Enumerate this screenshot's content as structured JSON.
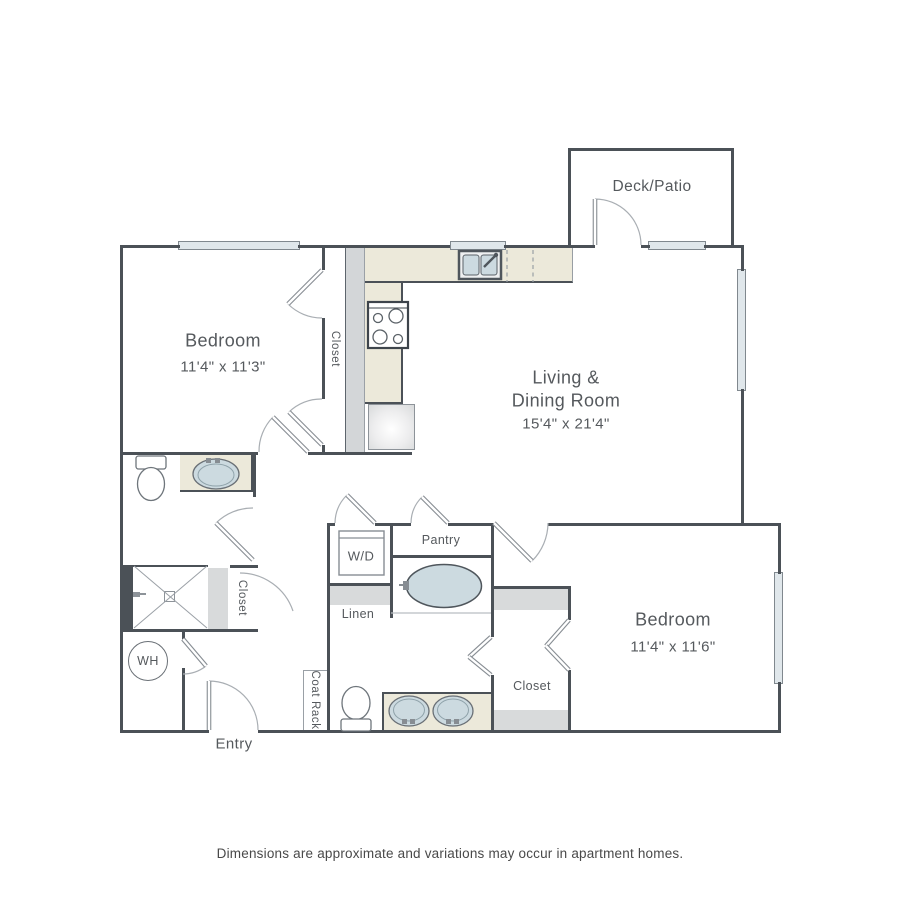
{
  "rooms": {
    "deck_patio": {
      "label": "Deck/Patio"
    },
    "bedroom_1": {
      "label": "Bedroom",
      "dimensions": "11'4\" x 11'3\""
    },
    "living_dining": {
      "label_line_1": "Living &",
      "label_line_2": "Dining Room",
      "dimensions": "15'4\" x 21'4\""
    },
    "bedroom_2": {
      "label": "Bedroom",
      "dimensions": "11'4\" x 11'6\""
    },
    "entry": {
      "label": "Entry"
    }
  },
  "features": {
    "bedroom_1_closet": {
      "label": "Closet"
    },
    "bathroom_1_closet": {
      "label": "Closet"
    },
    "bedroom_2_closet": {
      "label": "Closet"
    },
    "washer_dryer": {
      "label": "W/D"
    },
    "pantry": {
      "label": "Pantry"
    },
    "linen": {
      "label": "Linen"
    },
    "coat_rack": {
      "label": "Coat Rack"
    },
    "water_heater": {
      "label": "WH"
    }
  },
  "footer": {
    "disclaimer": "Dimensions are approximate and variations may occur in apartment homes."
  },
  "colors": {
    "wall": "#4b5157",
    "counter": "#ece9da",
    "shelf": "#d8dadb",
    "window_fill": "#e0e7eb",
    "water": "#ccdae0",
    "door_stroke": "#a9aeb3",
    "fixture_stroke": "#6e757b",
    "text": "#55595d"
  }
}
